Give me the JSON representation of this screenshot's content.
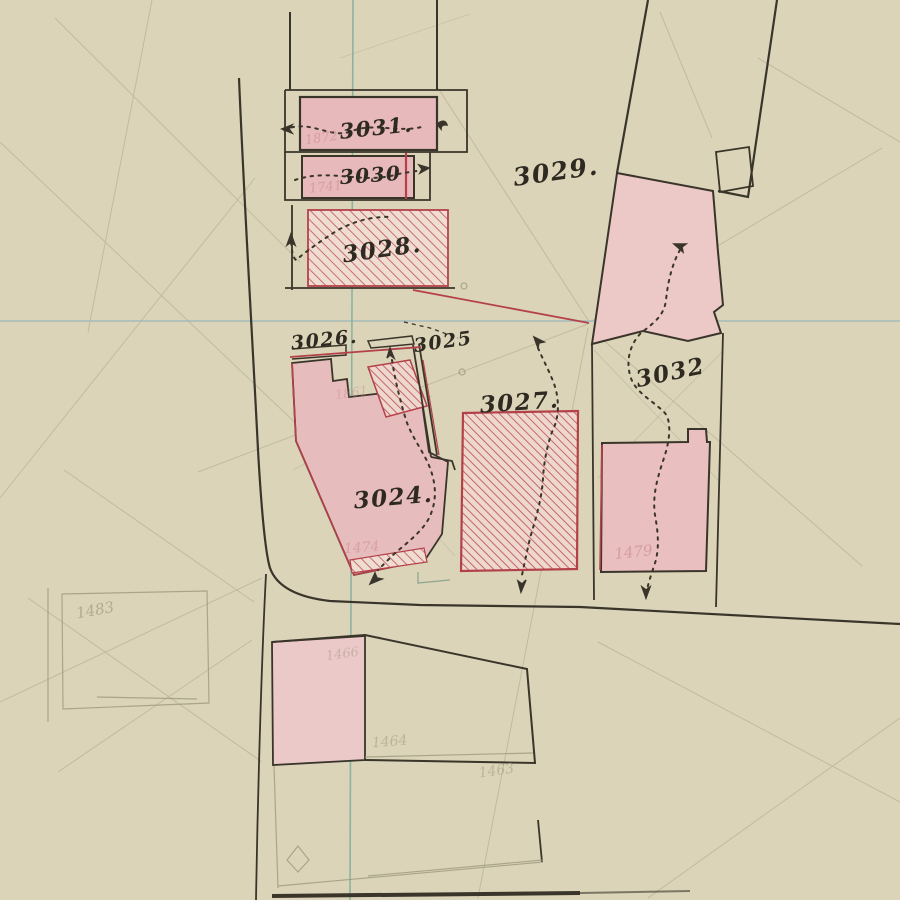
{
  "document": {
    "type": "hand-drawn cadastral survey plan",
    "description": "Aged paper plan with inked parcel outlines, pink building fills, red hatched parcels, dotted survey arrows, blue/teal register lines and faint pencil construction lines"
  },
  "palette": {
    "paper": "#d9d2b4",
    "ink": "#3a352b",
    "crimson": "#b4414a",
    "hatch_red": "#c4616c",
    "pink_fill": "#e7b9bb",
    "pink_light": "#ecc8c7",
    "teal_vertical": "#7fae9c",
    "blue_horizontal": "#9cb7bd",
    "pencil": "#8a8470",
    "faint_red_text": "#c9868c",
    "faint_pencil_text": "#9a957b"
  },
  "labels": {
    "p3031": "3031.",
    "p3030": "3030",
    "p3028": "3028.",
    "p3029": "3029.",
    "p3026": "3026.",
    "p3025": "3025",
    "p3027": "3027.",
    "p3024": "3024.",
    "p3032": "3032"
  },
  "faint_numbers": {
    "old3031": "1872",
    "old3030": "1741",
    "old3026": "1861",
    "old3024": "1474",
    "oldright": "1479",
    "bottomleft": "1483",
    "bottombuilding_top": "1466",
    "bottombuilding_mid": "1464",
    "bottombuilding_right": "1463"
  }
}
